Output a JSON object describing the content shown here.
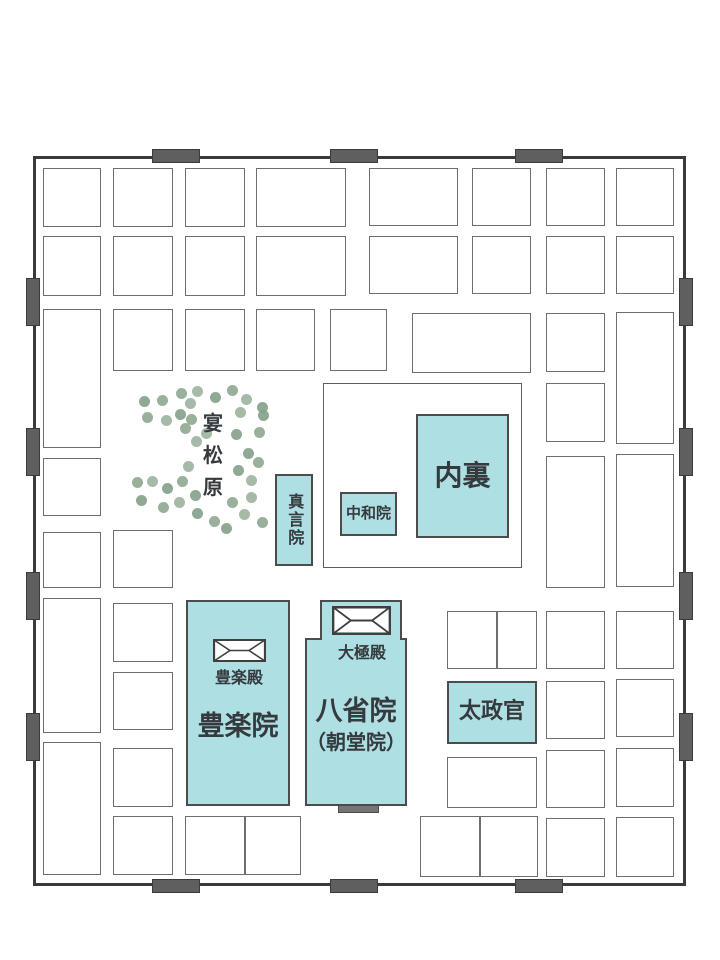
{
  "map": {
    "title_hint": "Heian Palace plan",
    "colors": {
      "building_fill": "#aedfe2",
      "building_border": "#4c4c4c",
      "wall": "#3a3a3a",
      "gate_fill": "#5f5f5f",
      "block_border": "#6e6e6e",
      "text": "#353a3e",
      "inner_gate_fill": "#757575",
      "dot_palette": [
        "#8ea990",
        "#9cb39e",
        "#83a089"
      ]
    },
    "wall": {
      "x": 33,
      "y": 156,
      "w": 653,
      "h": 730
    },
    "gates": {
      "size": 48,
      "thickness": 14,
      "top_x": [
        152,
        330,
        515
      ],
      "bottom_x": [
        152,
        330,
        515
      ],
      "left_y": [
        278,
        428,
        572,
        713
      ],
      "right_y": [
        278,
        428,
        572,
        713
      ]
    },
    "enclosure": {
      "x": 323,
      "y": 383,
      "w": 199,
      "h": 185
    },
    "blocks": [
      {
        "x": 43,
        "y": 168,
        "w": 58,
        "h": 59
      },
      {
        "x": 43,
        "y": 236,
        "w": 58,
        "h": 60
      },
      {
        "x": 43,
        "y": 309,
        "w": 58,
        "h": 139
      },
      {
        "x": 43,
        "y": 458,
        "w": 58,
        "h": 58
      },
      {
        "x": 43,
        "y": 532,
        "w": 58,
        "h": 56
      },
      {
        "x": 43,
        "y": 598,
        "w": 58,
        "h": 135
      },
      {
        "x": 43,
        "y": 742,
        "w": 58,
        "h": 133
      },
      {
        "x": 113,
        "y": 168,
        "w": 60,
        "h": 59
      },
      {
        "x": 113,
        "y": 236,
        "w": 60,
        "h": 60
      },
      {
        "x": 113,
        "y": 309,
        "w": 60,
        "h": 62
      },
      {
        "x": 113,
        "y": 530,
        "w": 60,
        "h": 58
      },
      {
        "x": 113,
        "y": 603,
        "w": 60,
        "h": 59
      },
      {
        "x": 113,
        "y": 672,
        "w": 60,
        "h": 58
      },
      {
        "x": 113,
        "y": 748,
        "w": 60,
        "h": 59
      },
      {
        "x": 113,
        "y": 816,
        "w": 60,
        "h": 59
      },
      {
        "x": 185,
        "y": 168,
        "w": 60,
        "h": 59
      },
      {
        "x": 185,
        "y": 236,
        "w": 60,
        "h": 60
      },
      {
        "x": 185,
        "y": 309,
        "w": 60,
        "h": 62
      },
      {
        "x": 256,
        "y": 168,
        "w": 90,
        "h": 59
      },
      {
        "x": 256,
        "y": 236,
        "w": 90,
        "h": 60
      },
      {
        "x": 256,
        "y": 309,
        "w": 59,
        "h": 62
      },
      {
        "x": 330,
        "y": 309,
        "w": 57,
        "h": 62
      },
      {
        "x": 369,
        "y": 168,
        "w": 89,
        "h": 58
      },
      {
        "x": 369,
        "y": 236,
        "w": 89,
        "h": 58
      },
      {
        "x": 472,
        "y": 168,
        "w": 59,
        "h": 58
      },
      {
        "x": 472,
        "y": 236,
        "w": 59,
        "h": 58
      },
      {
        "x": 412,
        "y": 313,
        "w": 119,
        "h": 60
      },
      {
        "x": 546,
        "y": 168,
        "w": 59,
        "h": 58
      },
      {
        "x": 546,
        "y": 236,
        "w": 59,
        "h": 58
      },
      {
        "x": 546,
        "y": 313,
        "w": 59,
        "h": 59
      },
      {
        "x": 546,
        "y": 383,
        "w": 59,
        "h": 59
      },
      {
        "x": 546,
        "y": 456,
        "w": 59,
        "h": 132
      },
      {
        "x": 546,
        "y": 611,
        "w": 59,
        "h": 58
      },
      {
        "x": 546,
        "y": 681,
        "w": 59,
        "h": 58
      },
      {
        "x": 546,
        "y": 750,
        "w": 59,
        "h": 58
      },
      {
        "x": 546,
        "y": 818,
        "w": 59,
        "h": 59
      },
      {
        "x": 616,
        "y": 168,
        "w": 58,
        "h": 58
      },
      {
        "x": 616,
        "y": 236,
        "w": 58,
        "h": 58
      },
      {
        "x": 616,
        "y": 312,
        "w": 58,
        "h": 132
      },
      {
        "x": 616,
        "y": 454,
        "w": 58,
        "h": 133
      },
      {
        "x": 616,
        "y": 611,
        "w": 58,
        "h": 58
      },
      {
        "x": 616,
        "y": 679,
        "w": 58,
        "h": 58
      },
      {
        "x": 616,
        "y": 748,
        "w": 58,
        "h": 59
      },
      {
        "x": 616,
        "y": 817,
        "w": 58,
        "h": 60
      },
      {
        "x": 185,
        "y": 816,
        "w": 116,
        "h": 59,
        "div": [
          58
        ]
      },
      {
        "x": 420,
        "y": 816,
        "w": 118,
        "h": 61,
        "div": [
          58
        ]
      },
      {
        "x": 447,
        "y": 611,
        "w": 90,
        "h": 58,
        "div": [
          48
        ]
      },
      {
        "x": 447,
        "y": 757,
        "w": 90,
        "h": 51
      }
    ],
    "buildings": [
      {
        "id": "dairi",
        "label": "内裏",
        "label_size": 28,
        "label_cy": 476,
        "rect": {
          "x": 416,
          "y": 414,
          "w": 93,
          "h": 124
        }
      },
      {
        "id": "chuwain",
        "label": "中和院",
        "label_size": 15,
        "label_cy": 514,
        "rect": {
          "x": 340,
          "y": 492,
          "w": 57,
          "h": 44
        }
      },
      {
        "id": "shingonin",
        "label": "真言院",
        "label_size": 16,
        "label_cy": 520,
        "vertical": true,
        "rect": {
          "x": 275,
          "y": 474,
          "w": 38,
          "h": 92
        }
      },
      {
        "id": "burakuin",
        "label": "豊楽院",
        "label_size": 27,
        "label_cy": 727,
        "rect": {
          "x": 186,
          "y": 600,
          "w": 104,
          "h": 206
        },
        "roof": {
          "x": 213,
          "y": 639,
          "w": 53,
          "h": 23
        },
        "hall_label": "豊楽殿",
        "hall_size": 16,
        "hall_cx": 239,
        "hall_cy": 678
      },
      {
        "id": "hasshoin",
        "label": "八省院",
        "label_size": 27,
        "label_cy": 712,
        "sub_label": "（朝堂院）",
        "sub_size": 20,
        "sub_cy": 742,
        "rect": {
          "x": 305,
          "y": 638,
          "w": 102,
          "h": 168
        },
        "top_rect": {
          "x": 320,
          "y": 600,
          "w": 82,
          "h": 40
        },
        "roof": {
          "x": 332,
          "y": 606,
          "w": 59,
          "h": 29
        },
        "hall_label": "大極殿",
        "hall_size": 16,
        "hall_cx": 362,
        "hall_cy": 653,
        "gate_bar": {
          "x": 338,
          "y": 805,
          "w": 41,
          "h": 8
        }
      },
      {
        "id": "daijokan",
        "label": "太政官",
        "label_size": 22,
        "label_cy": 712,
        "rect": {
          "x": 447,
          "y": 681,
          "w": 90,
          "h": 63
        }
      }
    ],
    "pine_grove": {
      "label": "宴松原",
      "chars": [
        "宴",
        "松",
        "原"
      ],
      "char_size": 20,
      "cx": 213,
      "top": 412,
      "gap": 9,
      "dot_r": 5.5,
      "dots": [
        [
          181,
          393
        ],
        [
          197,
          391
        ],
        [
          215,
          397
        ],
        [
          232,
          390
        ],
        [
          246,
          399
        ],
        [
          144,
          401
        ],
        [
          162,
          400
        ],
        [
          190,
          403
        ],
        [
          262,
          407
        ],
        [
          147,
          417
        ],
        [
          166,
          420
        ],
        [
          180,
          414
        ],
        [
          191,
          419
        ],
        [
          240,
          412
        ],
        [
          263,
          415
        ],
        [
          185,
          428
        ],
        [
          206,
          433
        ],
        [
          236,
          434
        ],
        [
          259,
          432
        ],
        [
          196,
          441
        ],
        [
          248,
          453
        ],
        [
          258,
          462
        ],
        [
          188,
          466
        ],
        [
          238,
          470
        ],
        [
          137,
          482
        ],
        [
          152,
          481
        ],
        [
          167,
          488
        ],
        [
          182,
          481
        ],
        [
          251,
          480
        ],
        [
          141,
          500
        ],
        [
          163,
          507
        ],
        [
          179,
          502
        ],
        [
          195,
          495
        ],
        [
          232,
          502
        ],
        [
          251,
          497
        ],
        [
          197,
          513
        ],
        [
          214,
          521
        ],
        [
          244,
          514
        ],
        [
          226,
          528
        ],
        [
          262,
          522
        ]
      ]
    }
  }
}
